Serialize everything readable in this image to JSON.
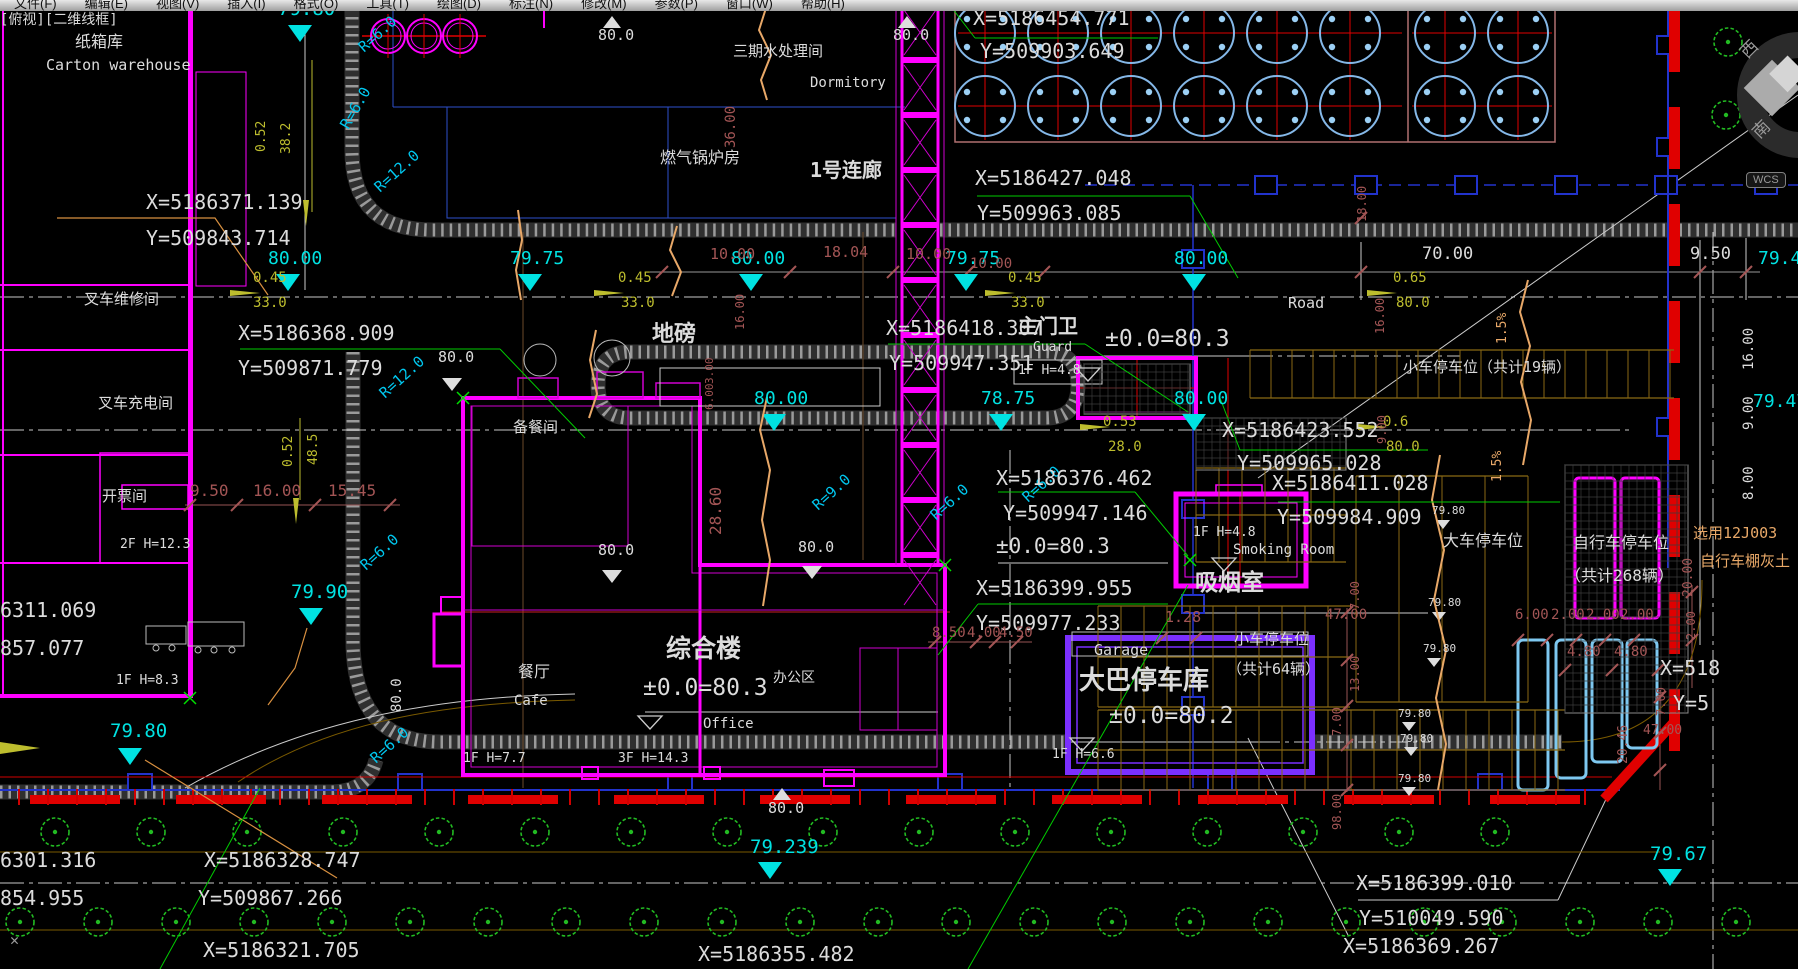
{
  "app": {
    "menu": [
      "文件(F)",
      "编辑(E)",
      "视图(V)",
      "插入(I)",
      "格式(O)",
      "工具(T)",
      "绘图(D)",
      "标注(N)",
      "修改(M)",
      "参数(P)",
      "窗口(W)",
      "帮助(H)"
    ],
    "view_label": "[俯视][二维线框]",
    "wcs": "WCS",
    "compass_west": "西",
    "compass_south": "南",
    "close_glyph": "✕"
  },
  "colors": {
    "background": "#000000",
    "building_magenta": "#FF00FF",
    "elevation_teal": "#00E2E2",
    "dim_yellow": "#BDBD2E",
    "dim_darkred": "#A35555",
    "slope_orange": "#E8A868",
    "radius_cyan": "#00C8F0",
    "tree_green": "#22BB22",
    "utility_blue": "#2233CC",
    "garage_purple": "#7B2FFF",
    "boundary_red": "#E00000",
    "bike_lightblue": "#7EC8F0"
  },
  "labels": [
    [
      "[俯视][二维线框]",
      0,
      13,
      "w",
      14,
      0,
      0,
      "viewport-label"
    ],
    [
      "纸箱库",
      75,
      34,
      "w",
      16
    ],
    [
      "Carton warehouse",
      46,
      58,
      "w",
      15
    ],
    [
      "X=5186371.139",
      146,
      192,
      "w",
      20
    ],
    [
      "Y=509843.714",
      146,
      228,
      "w",
      20
    ],
    [
      "叉车维修间",
      84,
      292,
      "w",
      15
    ],
    [
      "叉车充电间",
      98,
      396,
      "w",
      15
    ],
    [
      "开票间",
      102,
      489,
      "w",
      15
    ],
    [
      "2F H=12.3",
      120,
      538,
      "w",
      13
    ],
    [
      "1F H=8.3",
      116,
      674,
      "w",
      13
    ],
    [
      "6311.069",
      0,
      600,
      "w",
      20
    ],
    [
      "857.077",
      0,
      638,
      "w",
      20
    ],
    [
      "79.80",
      278,
      0,
      "t",
      19
    ],
    [
      "R=6.0",
      356,
      44,
      "c",
      15,
      -42
    ],
    [
      "R=6.0",
      338,
      124,
      "c",
      15,
      -60
    ],
    [
      "R=12.0",
      372,
      184,
      "c",
      15,
      -42
    ],
    [
      "0.52",
      255,
      152,
      "y",
      13,
      -90
    ],
    [
      "38.2",
      280,
      154,
      "y",
      13,
      -90
    ],
    [
      "80.0",
      598,
      28,
      "w",
      15
    ],
    [
      "三期水处理间",
      733,
      44,
      "w",
      15
    ],
    [
      "Dormitory",
      810,
      76,
      "w",
      14
    ],
    [
      "燃气锅炉房",
      660,
      150,
      "w",
      16
    ],
    [
      "36.00",
      724,
      148,
      "d",
      14,
      -90
    ],
    [
      "1号连廊",
      810,
      160,
      "w",
      20,
      0,
      1
    ],
    [
      "80.0",
      893,
      28,
      "w",
      15
    ],
    [
      "X=5186454.771",
      973,
      8,
      "w",
      20
    ],
    [
      "Y=509903.649",
      980,
      41,
      "w",
      20
    ],
    [
      "X=5186427.048",
      975,
      168,
      "w",
      20
    ],
    [
      "Y=509963.085",
      977,
      203,
      "w",
      20
    ],
    [
      "80.00",
      268,
      250,
      "t",
      18
    ],
    [
      "79.75",
      510,
      250,
      "t",
      18
    ],
    [
      "80.00",
      731,
      250,
      "t",
      18
    ],
    [
      "79.75",
      946,
      250,
      "t",
      18
    ],
    [
      "80.00",
      1174,
      250,
      "t",
      18
    ],
    [
      "0.45",
      253,
      271,
      "y",
      14
    ],
    [
      "33.0",
      253,
      296,
      "y",
      14
    ],
    [
      "0.45",
      618,
      271,
      "y",
      14
    ],
    [
      "33.0",
      621,
      296,
      "y",
      14
    ],
    [
      "0.45",
      1008,
      271,
      "y",
      14
    ],
    [
      "33.0",
      1011,
      296,
      "y",
      14
    ],
    [
      "0.65",
      1393,
      271,
      "y",
      14
    ],
    [
      "80.0",
      1396,
      296,
      "y",
      14
    ],
    [
      "10.00",
      710,
      247,
      "d",
      15
    ],
    [
      "18.04",
      823,
      245,
      "d",
      15
    ],
    [
      "10.00",
      906,
      247,
      "d",
      15
    ],
    [
      "10.00",
      970,
      257,
      "d",
      14
    ],
    [
      "16.00",
      734,
      330,
      "d",
      12,
      -90
    ],
    [
      "70.00",
      1422,
      246,
      "w",
      17
    ],
    [
      "9.50",
      1690,
      246,
      "w",
      17
    ],
    [
      "79.42",
      1758,
      250,
      "t",
      18
    ],
    [
      "Road",
      1288,
      296,
      "w",
      15
    ],
    [
      "16.00",
      1742,
      370,
      "w",
      14,
      -90
    ],
    [
      "9.00",
      1742,
      430,
      "w",
      14,
      -90
    ],
    [
      "8.00",
      1742,
      500,
      "w",
      14,
      -90
    ],
    [
      "18.00",
      1356,
      222,
      "d",
      12,
      -90
    ],
    [
      "小车停车位（共计19辆）",
      1403,
      360,
      "w",
      15
    ],
    [
      "1.5%",
      1496,
      344,
      "o",
      13,
      -90
    ],
    [
      "1.5%",
      1491,
      482,
      "o",
      13,
      -90
    ],
    [
      "79.47",
      1753,
      393,
      "t",
      18
    ],
    [
      "X=5186368.909",
      238,
      323,
      "w",
      20
    ],
    [
      "Y=509871.779",
      238,
      358,
      "w",
      20
    ],
    [
      "地磅",
      652,
      324,
      "w",
      22,
      0,
      1
    ],
    [
      "X=5186418.307",
      886,
      318,
      "w",
      20
    ],
    [
      "Y=509947.351",
      889,
      353,
      "w",
      20
    ],
    [
      "主门卫",
      1018,
      316,
      "w",
      20,
      0,
      1
    ],
    [
      "Guard",
      1033,
      341,
      "w",
      13
    ],
    [
      "1F H=4.8",
      1018,
      364,
      "w",
      13
    ],
    [
      "±0.0=80.3",
      1105,
      328,
      "w",
      23
    ],
    [
      "80.0",
      438,
      350,
      "w",
      15
    ],
    [
      "3.00",
      704,
      384,
      "d",
      11,
      -90
    ],
    [
      "6.00",
      704,
      410,
      "d",
      11,
      -90
    ],
    [
      "R=12.0",
      377,
      390,
      "c",
      15,
      -42
    ],
    [
      "0.52",
      282,
      467,
      "y",
      13,
      -90
    ],
    [
      "48.5",
      307,
      465,
      "y",
      13,
      -90
    ],
    [
      "9.50",
      190,
      483,
      "d",
      16
    ],
    [
      "16.00",
      253,
      483,
      "d",
      16
    ],
    [
      "15.45",
      328,
      483,
      "d",
      16
    ],
    [
      "备餐间",
      513,
      420,
      "w",
      15
    ],
    [
      "28.60",
      708,
      535,
      "d",
      16,
      -90
    ],
    [
      "80.00",
      754,
      390,
      "t",
      18
    ],
    [
      "78.75",
      981,
      390,
      "t",
      18
    ],
    [
      "80.00",
      1174,
      390,
      "t",
      18
    ],
    [
      "0.53",
      1103,
      415,
      "y",
      14
    ],
    [
      "28.0",
      1108,
      440,
      "y",
      14
    ],
    [
      "0.6",
      1383,
      415,
      "y",
      14
    ],
    [
      "80.0",
      1386,
      440,
      "y",
      14
    ],
    [
      "X=5186423.552",
      1222,
      420,
      "w",
      20
    ],
    [
      "Y=509965.028",
      1237,
      453,
      "w",
      20
    ],
    [
      "X=5186411.028",
      1272,
      473,
      "w",
      20
    ],
    [
      "Y=509984.909",
      1277,
      507,
      "w",
      20
    ],
    [
      "R=9.0",
      810,
      502,
      "c",
      15,
      -42
    ],
    [
      "R=6.0",
      928,
      512,
      "c",
      15,
      -42
    ],
    [
      "R=6.0",
      1020,
      494,
      "c",
      15,
      -42
    ],
    [
      "R=6.0",
      358,
      562,
      "c",
      15,
      -42
    ],
    [
      "R=6.0",
      368,
      755,
      "c",
      15,
      -42
    ],
    [
      "X=5186376.462",
      996,
      468,
      "w",
      20
    ],
    [
      "Y=509947.146",
      1003,
      503,
      "w",
      20
    ],
    [
      "±0.0=80.3",
      996,
      536,
      "w",
      21
    ],
    [
      "1F H=4.8",
      1193,
      526,
      "w",
      13
    ],
    [
      "Smoking Room",
      1233,
      543,
      "w",
      14
    ],
    [
      "吸烟室",
      1195,
      572,
      "w",
      23,
      0,
      1
    ],
    [
      "X=5186399.955",
      976,
      578,
      "w",
      20
    ],
    [
      "Y=509977.233",
      976,
      613,
      "w",
      20
    ],
    [
      "大车停车位",
      1443,
      533,
      "w",
      16
    ],
    [
      "自行车停车位",
      1573,
      535,
      "w",
      16
    ],
    [
      "（共计268辆）",
      1565,
      568,
      "w",
      16
    ],
    [
      "选用12J003",
      1693,
      526,
      "o",
      15
    ],
    [
      "自行车棚灰土",
      1700,
      554,
      "o",
      15
    ],
    [
      "16.00",
      1374,
      334,
      "d",
      12,
      -90
    ],
    [
      "9.00",
      1376,
      444,
      "d",
      12,
      -90
    ],
    [
      "79.80",
      1432,
      505,
      "w",
      11
    ],
    [
      "79.80",
      1428,
      597,
      "w",
      11
    ],
    [
      "79.80",
      1423,
      643,
      "w",
      11
    ],
    [
      "79.80",
      1398,
      708,
      "w",
      11
    ],
    [
      "79.80",
      1400,
      733,
      "w",
      11
    ],
    [
      "79.80",
      1398,
      773,
      "w",
      11
    ],
    [
      "20.00",
      1682,
      597,
      "d",
      13,
      -90
    ],
    [
      "2.00",
      1685,
      640,
      "d",
      12,
      -90
    ],
    [
      "X=518",
      1660,
      658,
      "w",
      20
    ],
    [
      "Y=5",
      1673,
      693,
      "w",
      20
    ],
    [
      "79.90",
      291,
      583,
      "t",
      19
    ],
    [
      "80.0",
      598,
      543,
      "w",
      15
    ],
    [
      "80.0",
      798,
      540,
      "w",
      15
    ],
    [
      "80.0",
      390,
      712,
      "w",
      14,
      -90
    ],
    [
      "综合楼",
      666,
      636,
      "w",
      25,
      0,
      1
    ],
    [
      "±0.0=80.3",
      643,
      677,
      "w",
      23
    ],
    [
      "办公区",
      773,
      671,
      "w",
      14
    ],
    [
      "Office",
      703,
      717,
      "w",
      14
    ],
    [
      "餐厅",
      518,
      664,
      "w",
      16
    ],
    [
      "Cafe",
      514,
      694,
      "w",
      14
    ],
    [
      "1F H=7.7",
      463,
      752,
      "w",
      13
    ],
    [
      "3F H=14.3",
      618,
      752,
      "w",
      13
    ],
    [
      "8.50",
      932,
      626,
      "d",
      14
    ],
    [
      "4.00",
      967,
      626,
      "d",
      14
    ],
    [
      "4.50",
      999,
      626,
      "d",
      14
    ],
    [
      "1.28",
      1165,
      610,
      "d",
      15
    ],
    [
      "Garage",
      1094,
      643,
      "w",
      15
    ],
    [
      "大巴停车库",
      1079,
      668,
      "w",
      26,
      0,
      1
    ],
    [
      "±0.0=80.2",
      1109,
      705,
      "w",
      23
    ],
    [
      "1F H=6.6",
      1052,
      748,
      "w",
      13
    ],
    [
      "小车停车位",
      1234,
      632,
      "w",
      15
    ],
    [
      "（共计64辆）",
      1227,
      662,
      "w",
      15
    ],
    [
      "47.00",
      1325,
      608,
      "d",
      14
    ],
    [
      "7.00",
      1349,
      610,
      "d",
      12,
      -90
    ],
    [
      "13.00",
      1349,
      692,
      "d",
      12,
      -90
    ],
    [
      "7.00",
      1331,
      736,
      "d",
      12,
      -90
    ],
    [
      "98.00",
      1331,
      830,
      "d",
      12,
      -90
    ],
    [
      "7.00",
      1655,
      716,
      "d",
      12,
      -90
    ],
    [
      "47.00",
      1643,
      724,
      "d",
      13
    ],
    [
      "6.00",
      1515,
      608,
      "d",
      14
    ],
    [
      "2.00",
      1551,
      608,
      "d",
      14
    ],
    [
      "2.00",
      1586,
      608,
      "d",
      14
    ],
    [
      "2.00",
      1620,
      608,
      "d",
      14
    ],
    [
      "4.80",
      1567,
      645,
      "d",
      14
    ],
    [
      "4.80",
      1614,
      645,
      "d",
      14
    ],
    [
      "20.46",
      1617,
      764,
      "d",
      13,
      -90
    ],
    [
      "79.80",
      110,
      722,
      "t",
      19
    ],
    [
      "6301.316",
      0,
      850,
      "w",
      20
    ],
    [
      "X=5186328.747",
      204,
      850,
      "w",
      20
    ],
    [
      "854.955",
      0,
      888,
      "w",
      20
    ],
    [
      "Y=509867.266",
      198,
      888,
      "w",
      20
    ],
    [
      "79.239",
      750,
      838,
      "t",
      19
    ],
    [
      "80.0",
      768,
      801,
      "w",
      15
    ],
    [
      "79.67",
      1650,
      845,
      "t",
      19
    ],
    [
      "X=5186399.010",
      1356,
      873,
      "w",
      20
    ],
    [
      "Y=510049.590",
      1359,
      908,
      "w",
      20
    ],
    [
      "X=5186321.705",
      203,
      940,
      "w",
      20
    ],
    [
      "X=5186355.482",
      698,
      944,
      "w",
      20
    ],
    [
      "X=5186369.267",
      1343,
      936,
      "w",
      20
    ],
    [
      "✕",
      10,
      933,
      "g",
      15,
      0,
      0,
      "ucs-close-icon"
    ],
    [
      "西",
      1738,
      50,
      "g",
      17,
      -45,
      0,
      "compass-west-label"
    ],
    [
      "南",
      1750,
      130,
      "g",
      17,
      -45,
      0,
      "compass-south-label"
    ]
  ]
}
